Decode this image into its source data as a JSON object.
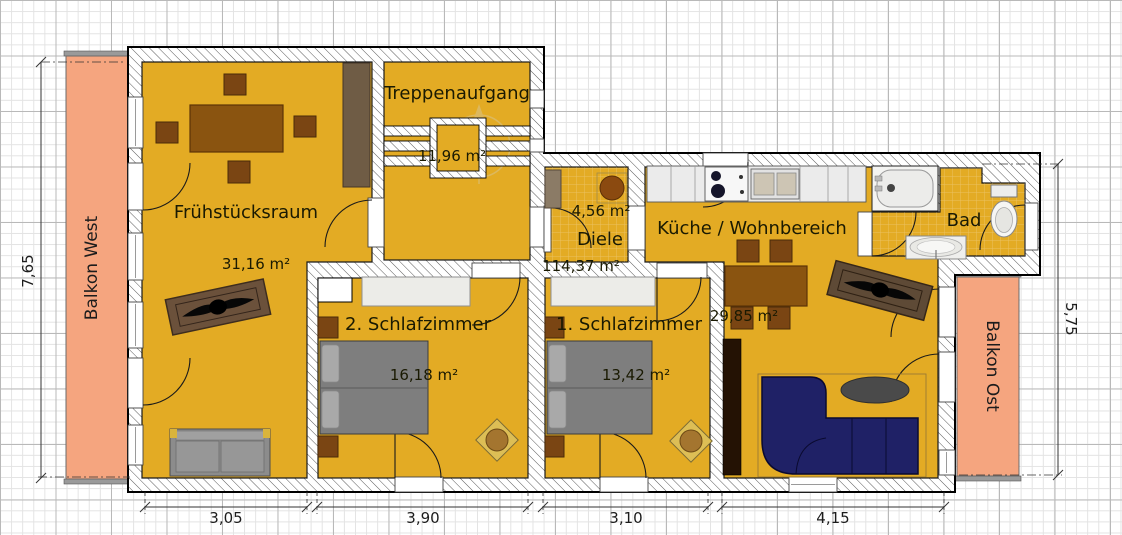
{
  "rooms": [
    {
      "id": "fruehstuecksraum",
      "name": "Frühstücksraum",
      "area": "31,16 m²"
    },
    {
      "id": "treppenaufgang",
      "name": "Treppenaufgang",
      "area": "11,96 m²"
    },
    {
      "id": "diele",
      "name": "Diele",
      "area": "4,56 m²"
    },
    {
      "id": "kueche-wohnbereich",
      "name": "Küche / Wohnbereich",
      "area": "29,85 m²"
    },
    {
      "id": "bad",
      "name": "Bad"
    },
    {
      "id": "schlafzimmer2",
      "name": "2. Schlafzimmer",
      "area": "16,18 m²"
    },
    {
      "id": "schlafzimmer1",
      "name": "1. Schlafzimmer",
      "area": "13,42 m²"
    }
  ],
  "balconies": [
    {
      "label": "Balkon West"
    },
    {
      "label": "Balkon Ost"
    }
  ],
  "total_area": "114,37 m²",
  "dimensions": {
    "left": "7,65",
    "right": "5,75",
    "bottom": [
      "3,05",
      "3,90",
      "3,10",
      "4,15"
    ]
  },
  "colors": {
    "room_fill": "#E3AB24",
    "balcony_fill": "#F5A57F",
    "sofa_blue": "#1F2166",
    "wood": "#8A5410",
    "text": "#1A1A02"
  }
}
